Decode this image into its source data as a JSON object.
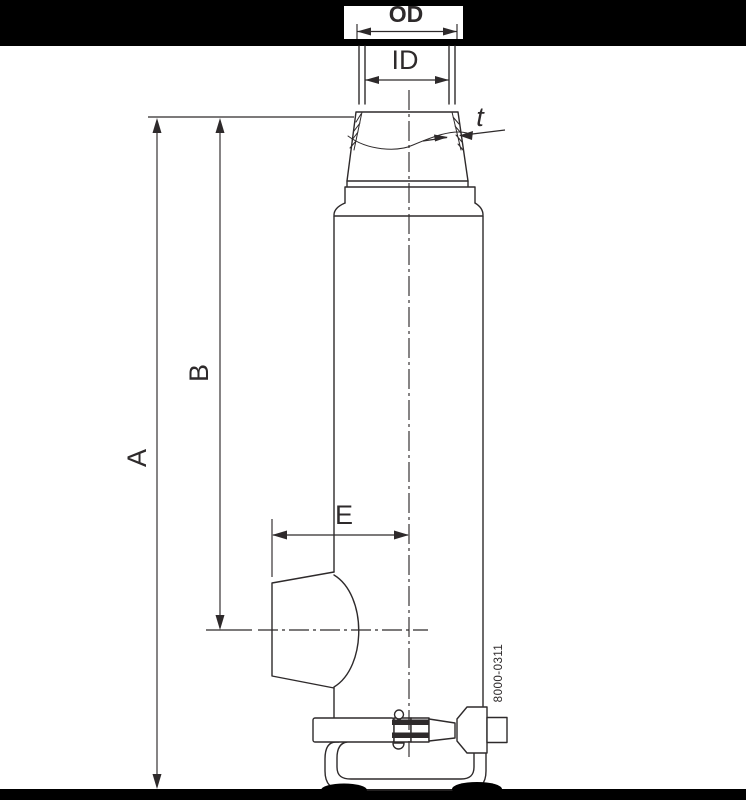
{
  "labels": {
    "outer_diameter": "OD",
    "inner_diameter": "ID",
    "wall_thickness": "t",
    "overall_height": "A",
    "outlet_height": "B",
    "outlet_extension": "E"
  },
  "drawing_number": "8000-0311",
  "colors": {
    "line": "#2e2a2b",
    "band": "#000000",
    "page": "#ffffff"
  }
}
